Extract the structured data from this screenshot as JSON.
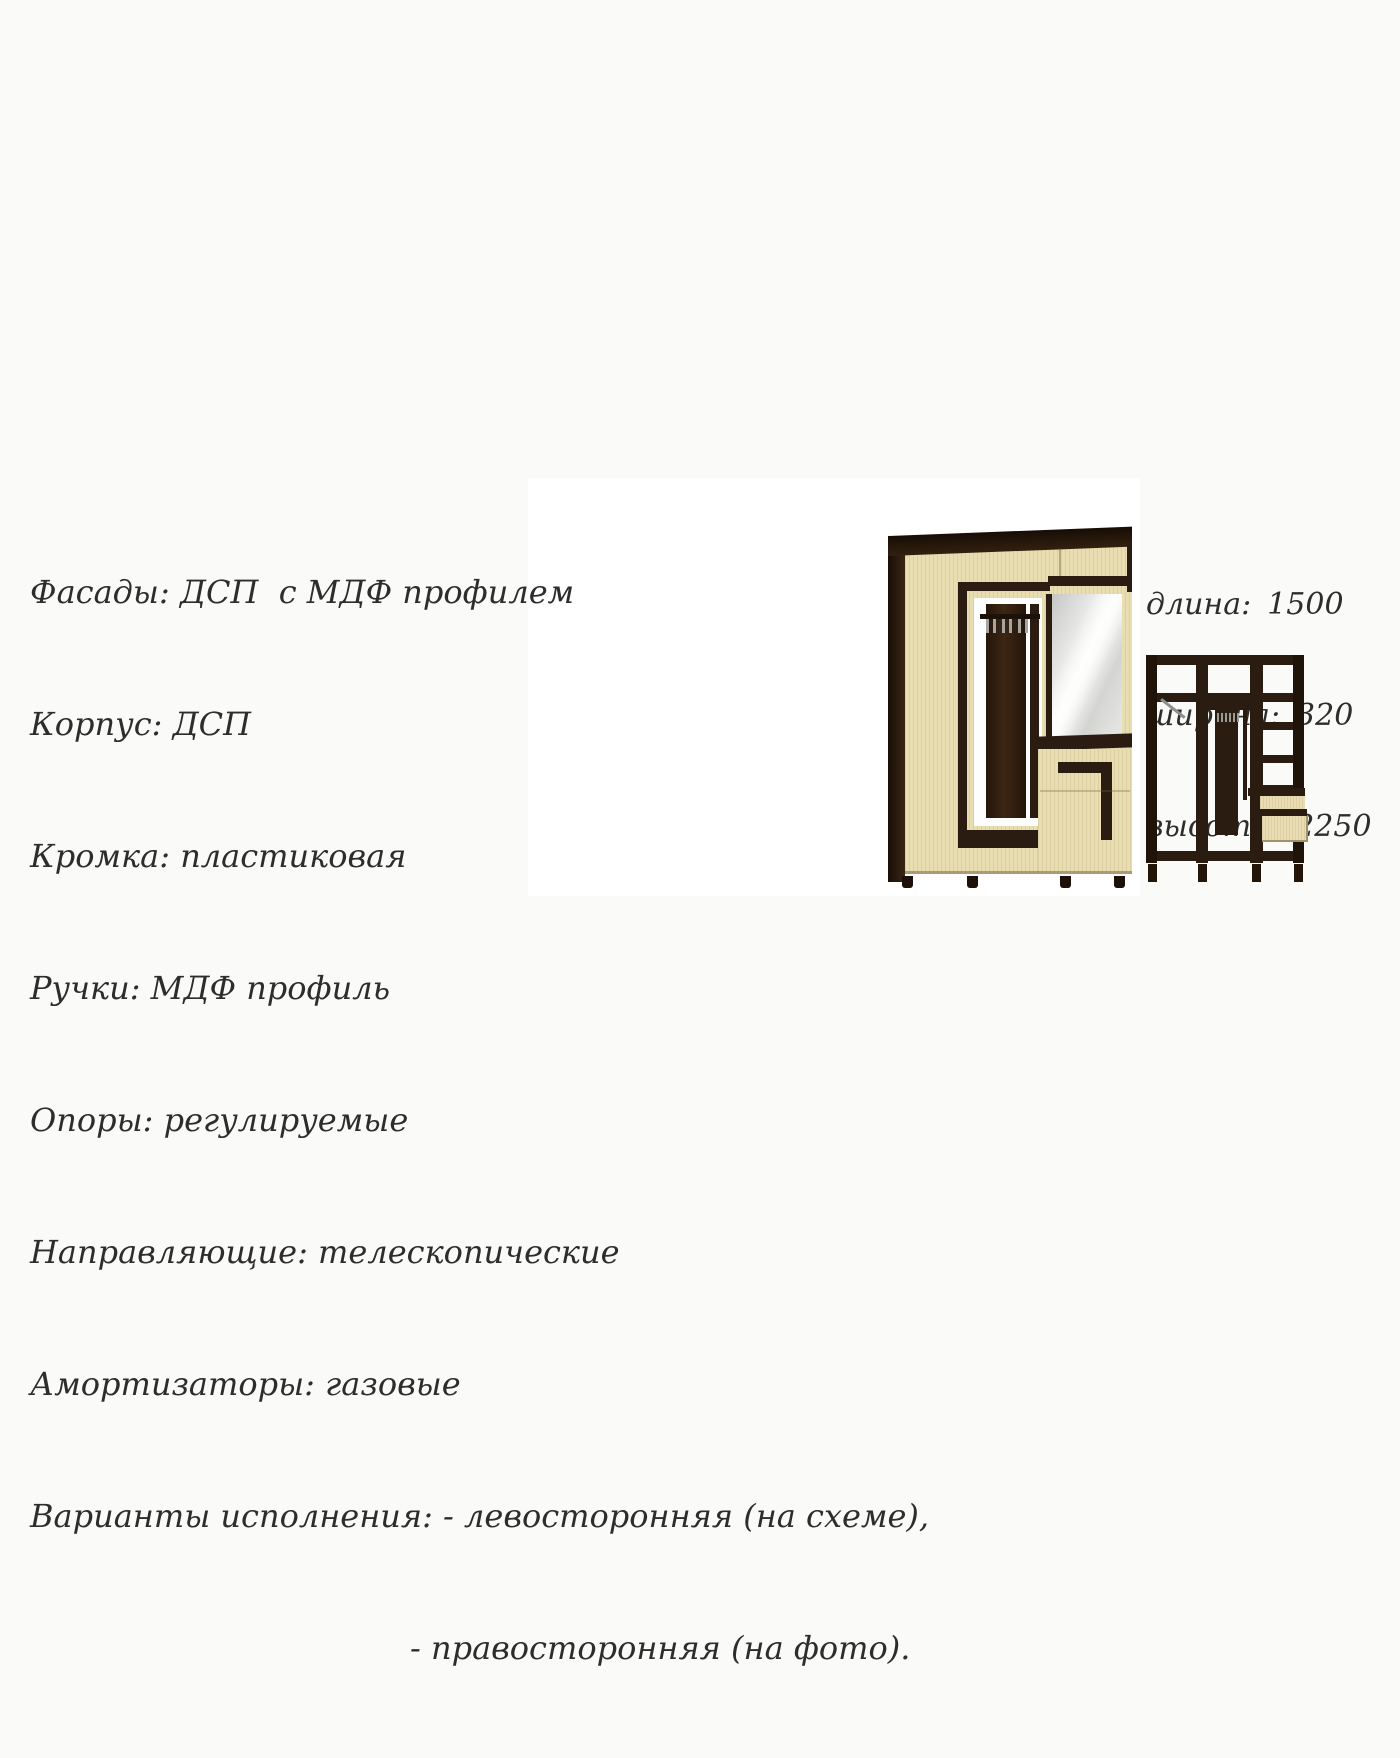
{
  "page": {
    "background_color": "#fafaf8"
  },
  "specs": {
    "lines": [
      "Фасады: ДСП  с МДФ профилем",
      "Корпус: ДСП",
      "Кромка: пластиковая",
      "Ручки: МДФ профиль",
      "Опоры: регулируемые",
      "Направляющие: телескопические",
      "Амортизаторы: газовые",
      "Варианты исполнения: - левосторонняя (на схеме),",
      "- правосторонняя (на фото)."
    ]
  },
  "dimensions": {
    "rows": [
      {
        "label": "длина:",
        "value": "1500"
      },
      {
        "label": "ширина:",
        "value": "320"
      },
      {
        "label": "высота:",
        "value": "2250"
      }
    ]
  },
  "colors": {
    "body_light": "#e9ddb2",
    "trim_dark": "#2b1c11",
    "mirror_gray": "#dddddb",
    "text": "#2e2d2b"
  },
  "icons": {
    "coat_hook": "coat-hook-icon",
    "hanger_rod": "hanger-rod-icon"
  }
}
